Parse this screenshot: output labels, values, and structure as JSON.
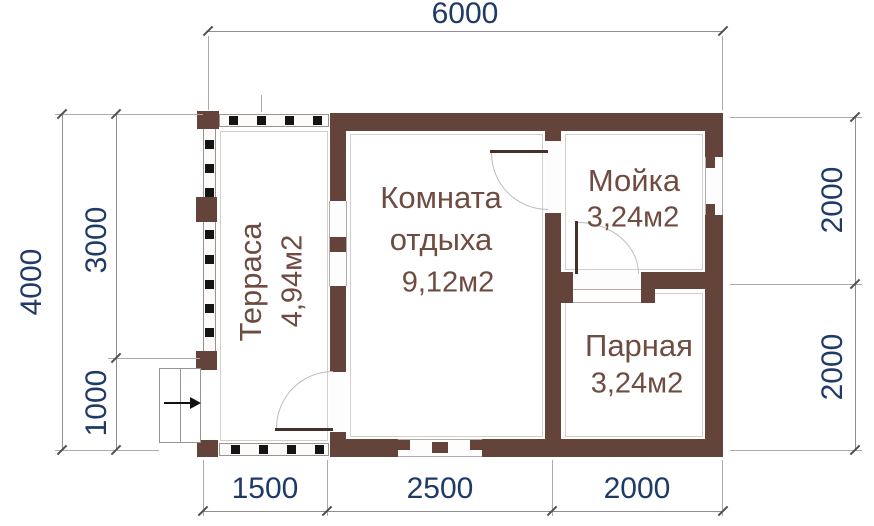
{
  "plan": {
    "rooms": {
      "terrace": {
        "name": "Терраса",
        "area": "4,94м2"
      },
      "rest_room": {
        "name": "Комната отдыха",
        "area": "9,12м2"
      },
      "washing_room": {
        "name": "Мойка",
        "area": "3,24м2"
      },
      "steam_room": {
        "name": "Парная",
        "area": "3,24м2"
      }
    },
    "dimensions": {
      "top_width": "6000",
      "bottom_segments": [
        "1500",
        "2500",
        "2000"
      ],
      "left_total": "4000",
      "left_segments": [
        "3000",
        "1000"
      ],
      "right_segments": [
        "2000",
        "2000"
      ]
    },
    "colors": {
      "wall": "#64443a",
      "room_label": "#6f4c42",
      "dimension_text": "#1f3a67",
      "dimension_line": "#8f8f8f",
      "railing_dot": "#141414",
      "background": "#ffffff"
    }
  }
}
